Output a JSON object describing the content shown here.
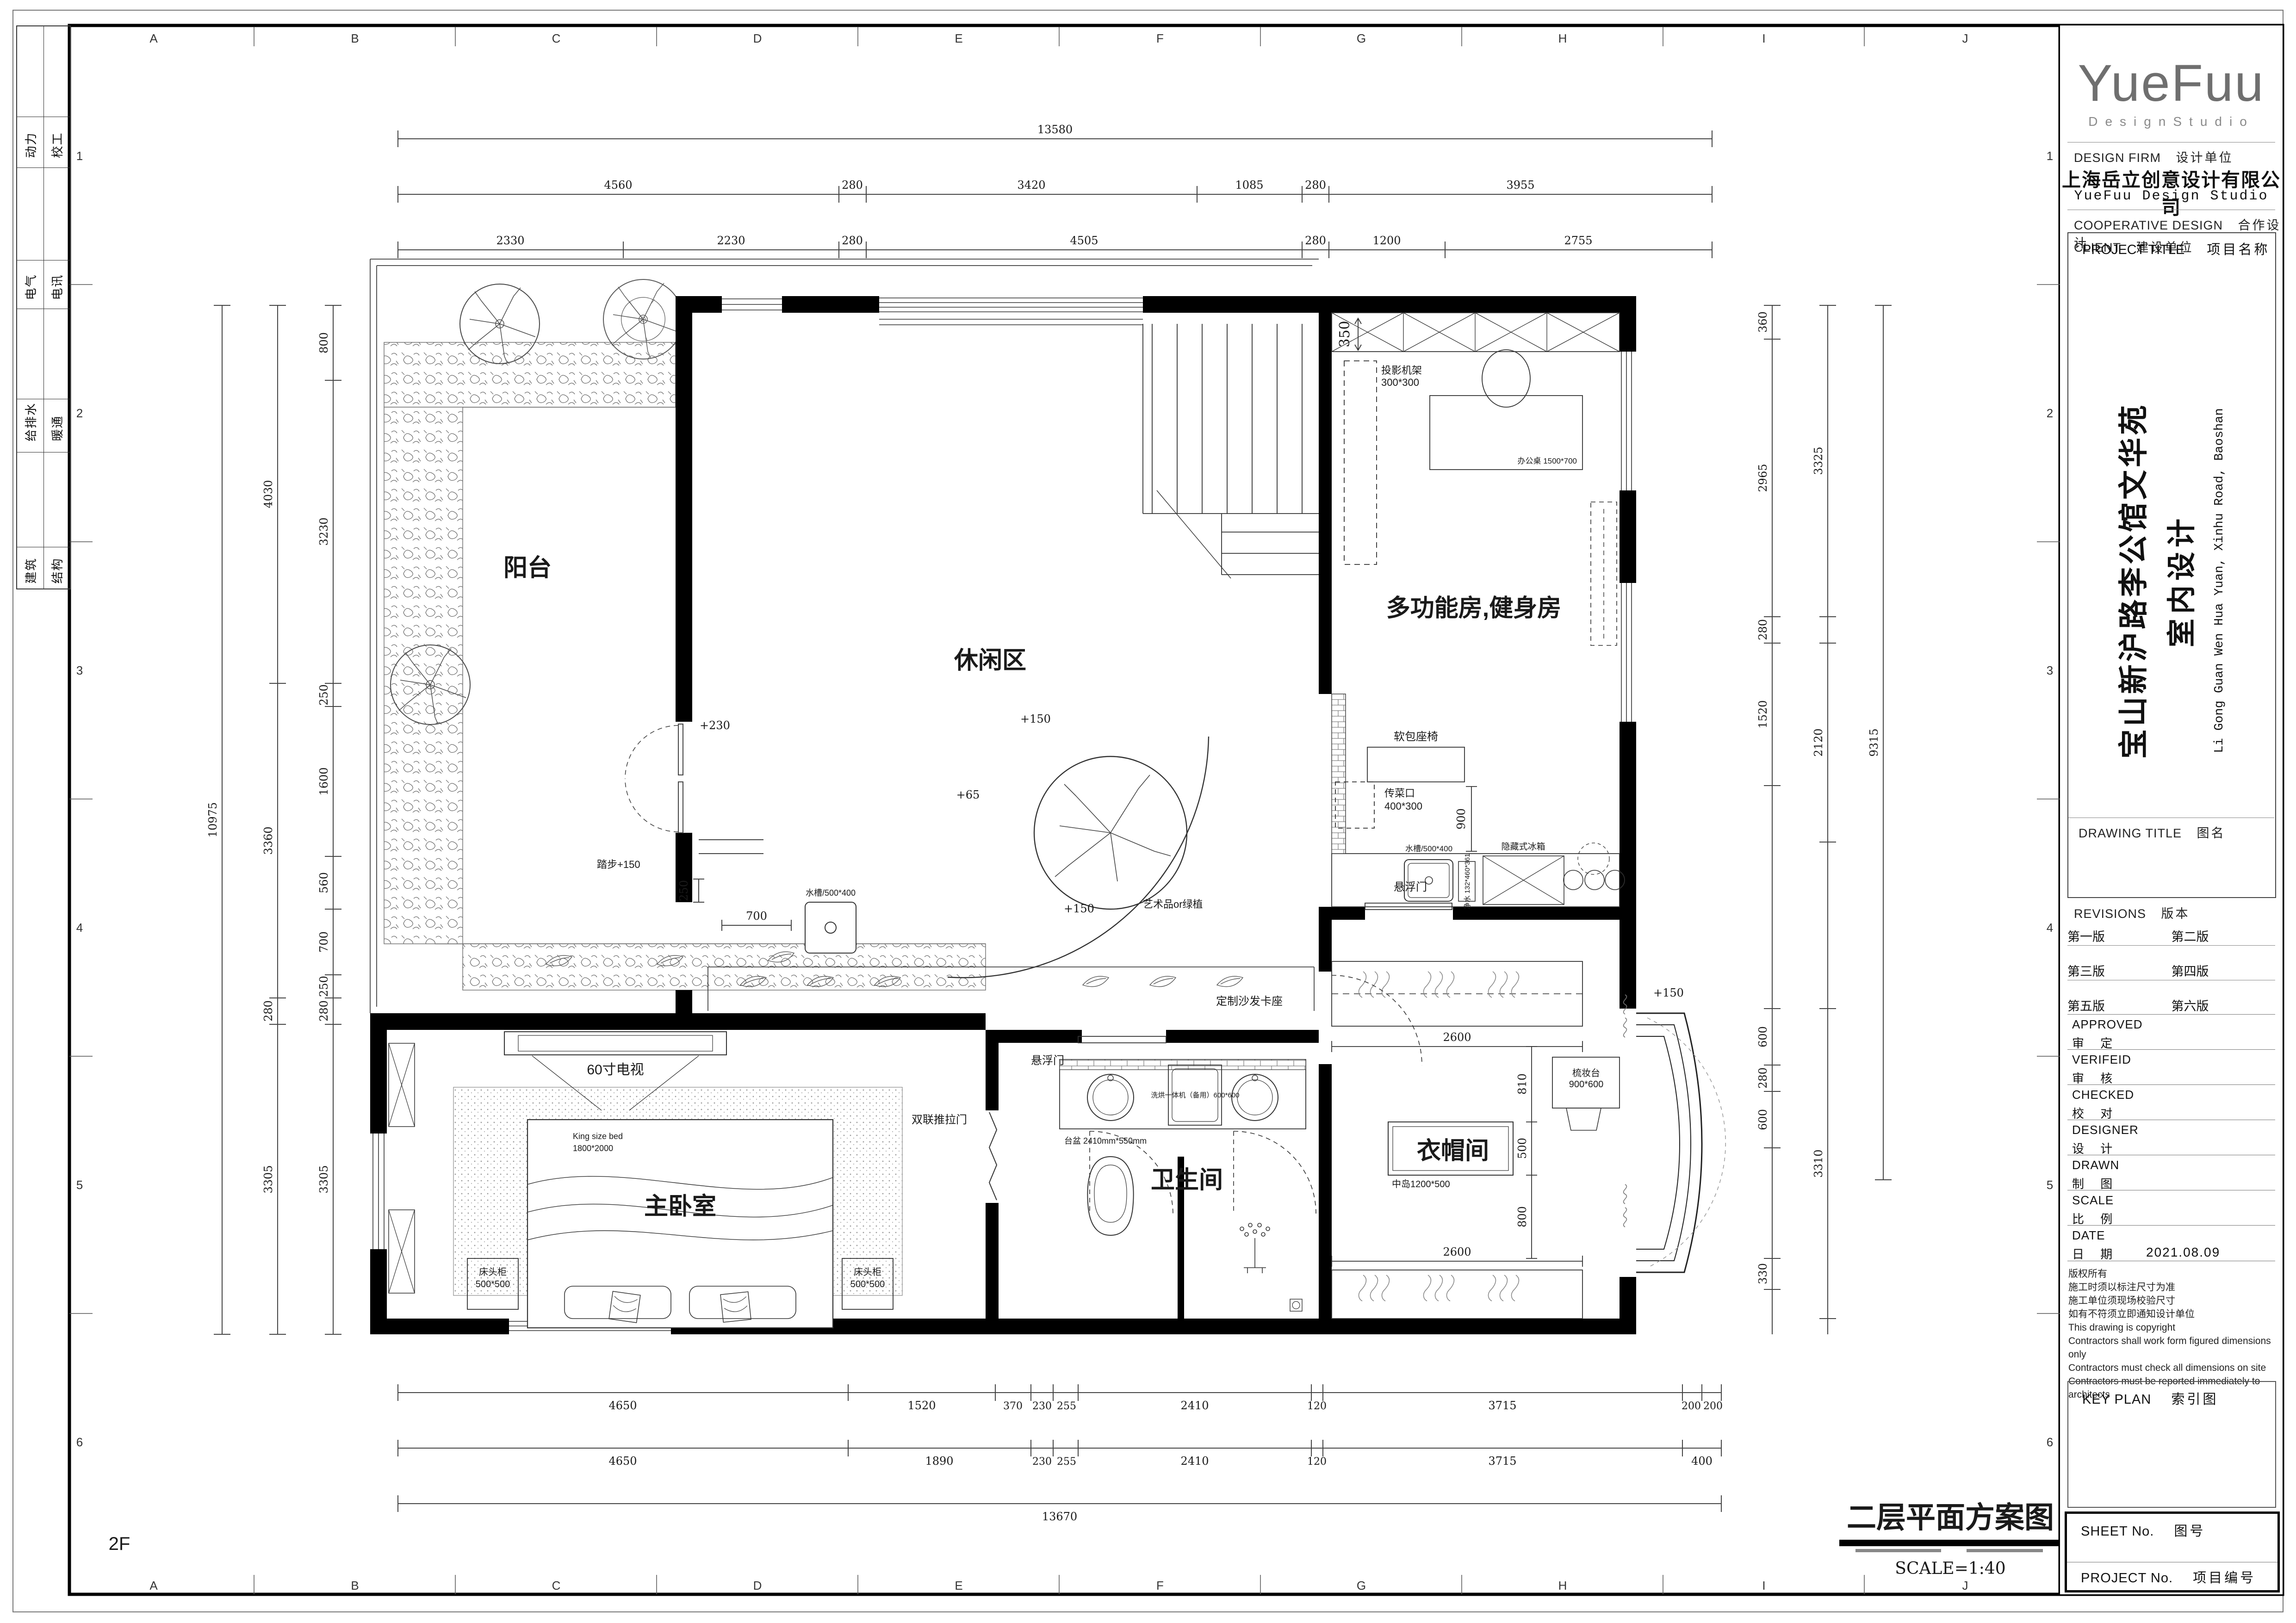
{
  "sheet": {
    "floor_code": "2F"
  },
  "grid": {
    "letters": [
      "A",
      "B",
      "C",
      "D",
      "E",
      "F",
      "G",
      "H",
      "I",
      "J"
    ],
    "numbers": [
      "1",
      "2",
      "3",
      "4",
      "5",
      "6"
    ]
  },
  "margin_table": {
    "rows": [
      [
        "动力",
        "校工"
      ],
      [
        "电气",
        "电讯"
      ],
      [
        "给排水",
        "暖通"
      ],
      [
        "建筑",
        "结构"
      ]
    ]
  },
  "title_block": {
    "logo": "YueFuu",
    "logo_sub": "DesignStudio",
    "design_firm_en": "DESIGN FIRM",
    "design_firm_cn": "设计单位",
    "company_cn": "上海岳立创意设计有限公司",
    "company_en": "YueFuu Design Studio",
    "coop_en": "COOPERATIVE DESIGN",
    "coop_cn": "合作设计",
    "client_en": "CLIENT",
    "client_cn": "建设单位",
    "project_title_en": "PROJECT TITLE",
    "project_title_cn": "项目名称",
    "project_name_cn": "宝山新沪路李公馆文华苑",
    "project_name_cn2": "室内设计",
    "project_name_en": "Li Gong Guan Wen Hua Yuan, Xinhu Road, Baoshan",
    "drawing_title_en": "DRAWING TITLE",
    "drawing_title_cn": "图名",
    "revisions_en": "REVISIONS",
    "revisions_cn": "版本",
    "revs": [
      "第一版",
      "第二版",
      "第三版",
      "第四版",
      "第五版",
      "第六版"
    ],
    "staff": [
      {
        "en": "APPROVED",
        "cn": "审 定",
        "val": ""
      },
      {
        "en": "VERIFEID",
        "cn": "审 核",
        "val": ""
      },
      {
        "en": "CHECKED",
        "cn": "校 对",
        "val": ""
      },
      {
        "en": "DESIGNER",
        "cn": "设 计",
        "val": ""
      },
      {
        "en": "DRAWN",
        "cn": "制 图",
        "val": ""
      },
      {
        "en": "SCALE",
        "cn": "比 例",
        "val": ""
      },
      {
        "en": "DATE",
        "cn": "日 期",
        "val": "2021.08.09"
      }
    ],
    "copyright": [
      "版权所有",
      "施工时须以标注尺寸为准",
      "施工单位须现场校验尺寸",
      "如有不符须立即通知设计单位",
      "This drawing is copyright",
      "Contractors shall work form figured dimensions only",
      "Contractors must check all dimensions on site",
      "Contractors must be reported immediately to architects"
    ],
    "key_plan_en": "KEY PLAN",
    "key_plan_cn": "索引图",
    "sheet_no_en": "SHEET No.",
    "sheet_no_cn": "图号",
    "project_no_en": "PROJECT No.",
    "project_no_cn": "项目编号"
  },
  "plan": {
    "rooms": {
      "balcony": "阳台",
      "leisure": "休闲区",
      "gym": "多功能房,健身房",
      "bath": "卫生间",
      "bedroom": "主卧室",
      "cloak": "衣帽间"
    },
    "annotations": {
      "tv": "60寸电视",
      "bed_type": "King size bed",
      "bed_size": "1800*2000",
      "nightstand": "床头柜",
      "nightstand_size": "500*500",
      "sofa": "定制沙发卡座",
      "soft_seat": "软包座椅",
      "float_door": "悬浮门",
      "float_door2": "悬浮门",
      "art": "艺术品or绿植",
      "pass": "传菜口",
      "pass_size": "400*300",
      "washer": "洗烘一体机（备用）600*600",
      "basin_counter": "台盆  2410mm*550mm",
      "slide_door": "双联推拉门",
      "sink1": "水槽/500*400",
      "sink2": "水槽/500*400",
      "purifier": "净水 132*460*361",
      "fridge": "隐藏式冰箱",
      "projector": "投影机架",
      "projector_size": "300*300",
      "desk": "办公桌 1500*700",
      "dresser": "梳妆台",
      "dresser_size": "900*600",
      "island": "中岛1200*500",
      "step": "踏步+150"
    },
    "levels": {
      "l1": "+150",
      "l2": "+65",
      "l3": "+150",
      "l4": "+230",
      "l5": "+150"
    },
    "dims": {
      "top1": [
        "13580"
      ],
      "top2": [
        "4560",
        "280",
        "3420",
        "1085",
        "280",
        "3955"
      ],
      "top3": [
        "2330",
        "2230",
        "280",
        "4505",
        "280",
        "1200",
        "2755"
      ],
      "left1": [
        "10975"
      ],
      "left2": [
        "4030",
        "3360",
        "280",
        "3305"
      ],
      "left3": [
        "800",
        "3230",
        "250",
        "1600",
        "560",
        "700",
        "250",
        "280",
        "3305"
      ],
      "right1": [
        "360",
        "2965",
        "280",
        "1520",
        "600",
        "280",
        "600",
        "330"
      ],
      "right2": [
        "3325",
        "2120",
        "3310"
      ],
      "right3": [
        "9315"
      ],
      "bottom1": [
        "4650",
        "1520",
        "370",
        "230",
        "255",
        "2410",
        "120",
        "3715",
        "200",
        "200"
      ],
      "bottom2": [
        "4650",
        "1890",
        "230",
        "255",
        "2410",
        "120",
        "3715",
        "400"
      ],
      "bottom3": [
        "13670"
      ],
      "inner": [
        "2600",
        "2600",
        "810",
        "500",
        "800",
        "900",
        "350",
        "700",
        "250"
      ]
    }
  },
  "footer": {
    "title": "二层平面方案图",
    "scale": "SCALE=1:40"
  }
}
